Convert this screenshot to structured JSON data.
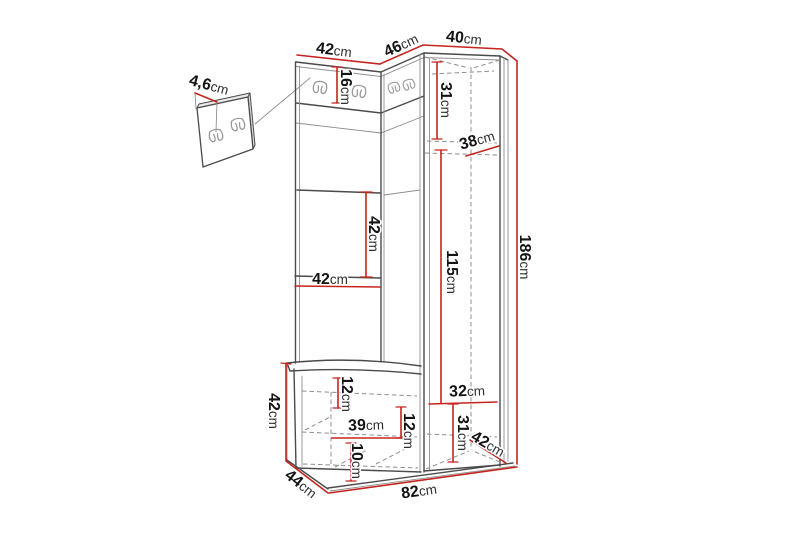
{
  "diagram": {
    "kind": "furniture-dimension-drawing",
    "subject": "hallway unit with wall hook panel, open shelves, bench and tall cabinet",
    "unit": "cm"
  },
  "colors": {
    "background": "#ffffff",
    "dimension_line": "#c5251f",
    "outline": "#4b4b4b",
    "outline_light": "#8f8f8f",
    "label_text": "#141414"
  },
  "icons": {
    "coat_hook": "double-coat-hook-icon"
  },
  "dims": {
    "panel_thickness": {
      "value": "4,6",
      "unit": "cm"
    },
    "top_left_width": {
      "value": "42",
      "unit": "cm"
    },
    "top_corner_width": {
      "value": "46",
      "unit": "cm"
    },
    "top_right_width": {
      "value": "40",
      "unit": "cm"
    },
    "hook_panel_height": {
      "value": "16",
      "unit": "cm"
    },
    "cabinet_top_height": {
      "value": "31",
      "unit": "cm"
    },
    "cabinet_top_depth": {
      "value": "38",
      "unit": "cm"
    },
    "shelf_section_height": {
      "value": "42",
      "unit": "cm"
    },
    "shelf_width": {
      "value": "42",
      "unit": "cm"
    },
    "cabinet_middle_height": {
      "value": "115",
      "unit": "cm"
    },
    "total_height": {
      "value": "186",
      "unit": "cm"
    },
    "bench_height": {
      "value": "42",
      "unit": "cm"
    },
    "bench_top_section": {
      "value": "12",
      "unit": "cm"
    },
    "bench_inner_width": {
      "value": "39",
      "unit": "cm"
    },
    "bench_middle_section": {
      "value": "12",
      "unit": "cm"
    },
    "bench_bottom_section": {
      "value": "10",
      "unit": "cm"
    },
    "bench_depth": {
      "value": "44",
      "unit": "cm"
    },
    "cabinet_inner_width": {
      "value": "32",
      "unit": "cm"
    },
    "cabinet_bottom_height": {
      "value": "31",
      "unit": "cm"
    },
    "cabinet_depth": {
      "value": "42",
      "unit": "cm"
    },
    "total_width": {
      "value": "82",
      "unit": "cm"
    }
  }
}
